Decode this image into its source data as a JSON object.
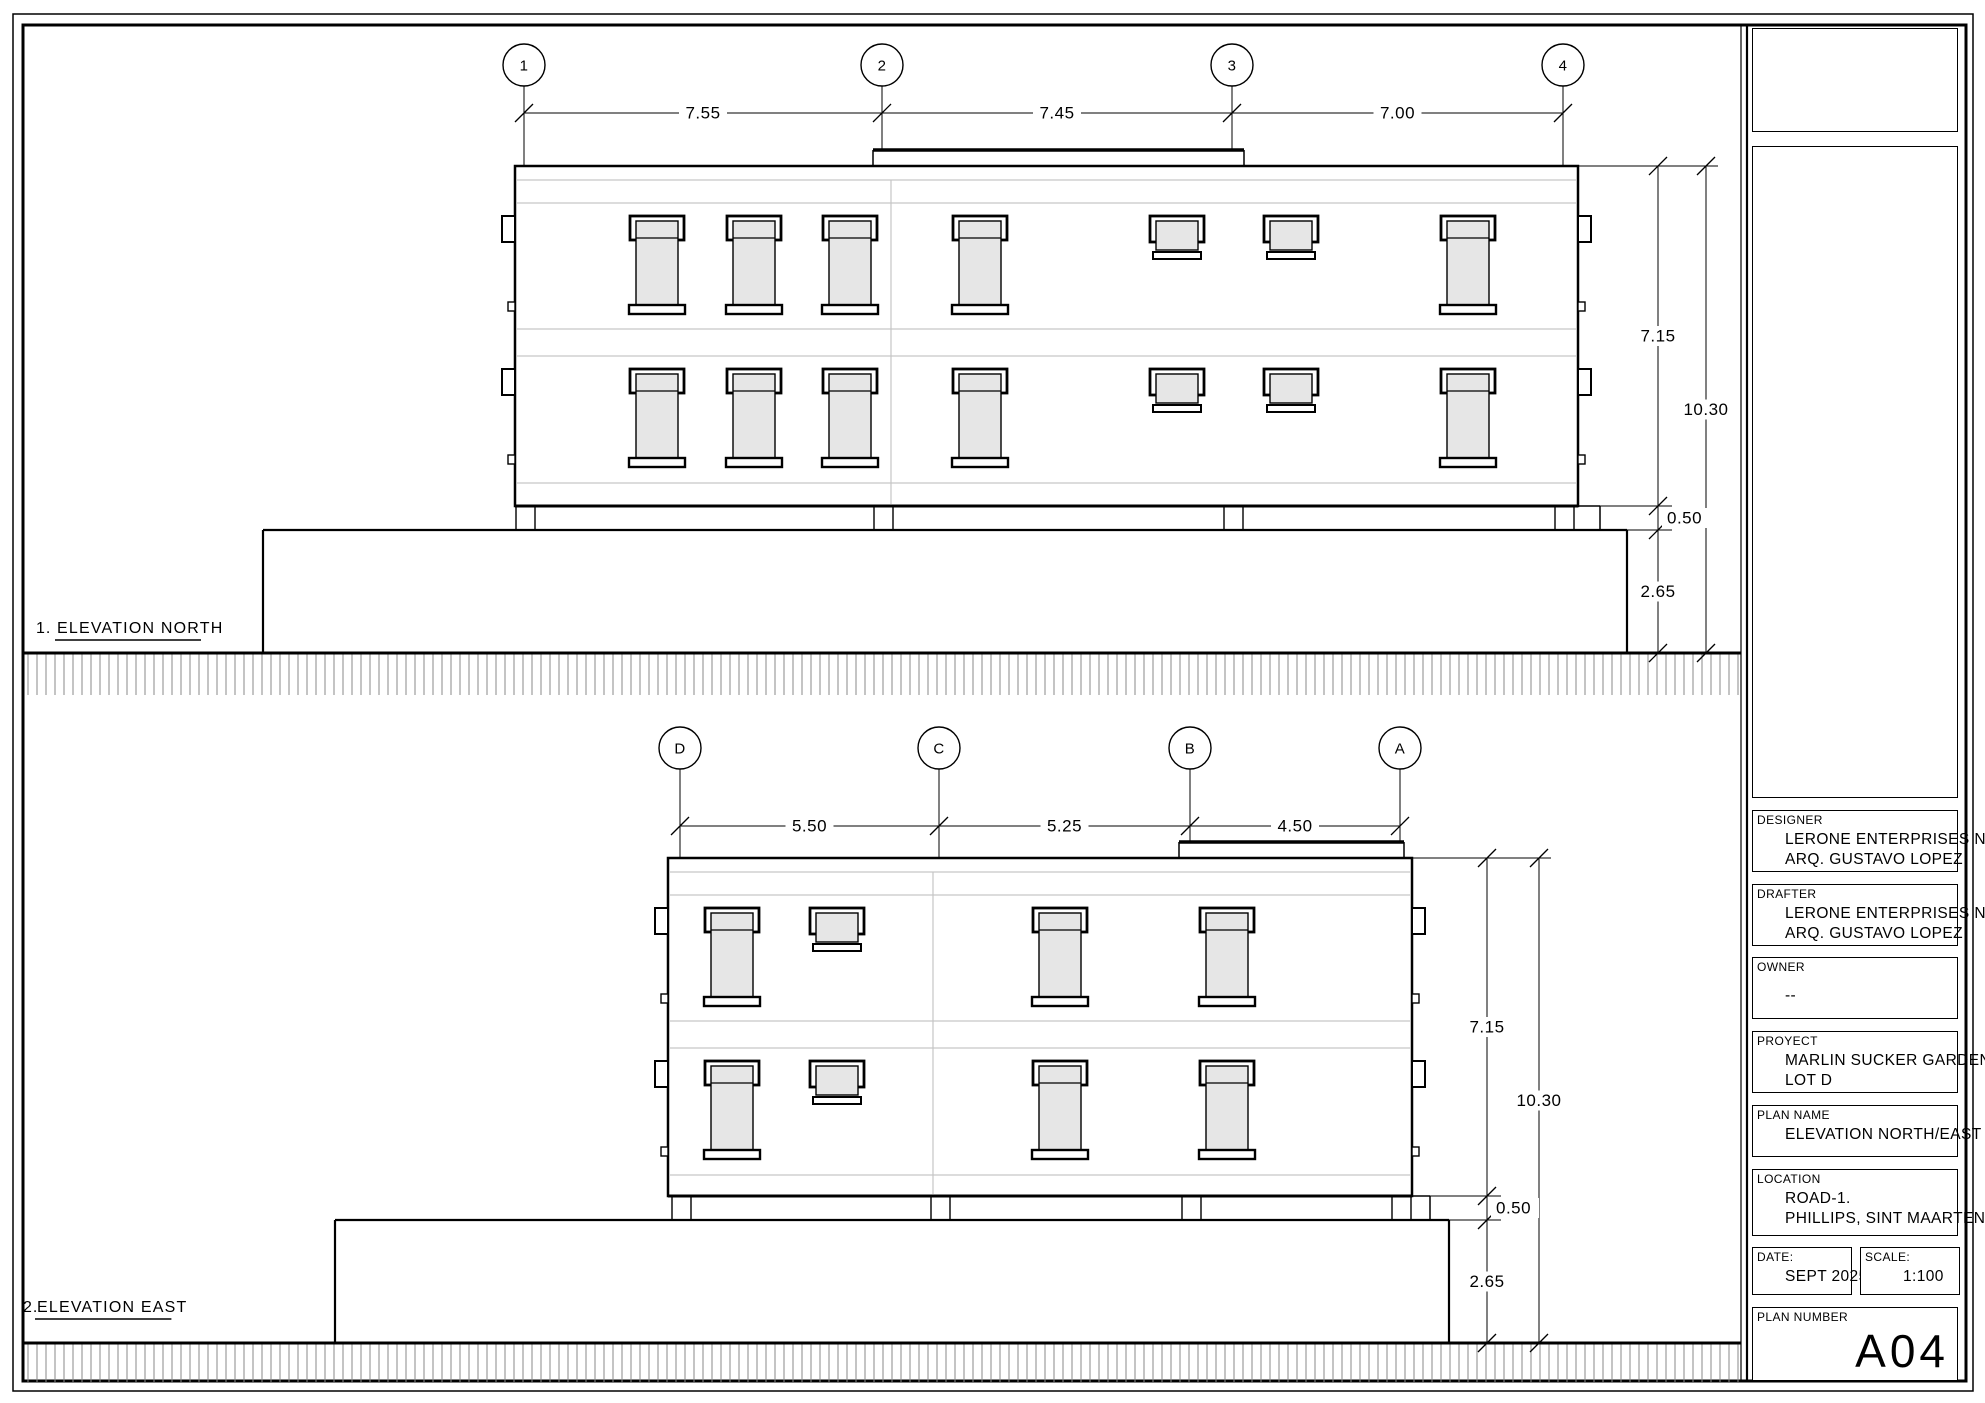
{
  "sheet": {
    "line_color": "#000000",
    "faint_color": "#c6c6c6",
    "glass_color": "#e6e6e6",
    "hatch_color": "#8a8a8a"
  },
  "drawings": [
    {
      "id": "north-elevation",
      "number": "1.",
      "title": "ELEVATION NORTH",
      "title_pos": {
        "num_x": 36,
        "title_x": 57,
        "y": 633
      },
      "bubbles_y": 65,
      "dim_line_y": 113,
      "grids": [
        {
          "label": "1",
          "x": 524
        },
        {
          "label": "2",
          "x": 882
        },
        {
          "label": "3",
          "x": 1232
        },
        {
          "label": "4",
          "x": 1563
        }
      ],
      "span_dims": [
        "7.55",
        "7.45",
        "7.00"
      ],
      "building": {
        "left": 515,
        "right": 1578,
        "top": 166,
        "bottom": 506
      },
      "parapet": {
        "left": 873,
        "right": 1244,
        "top": 150
      },
      "band_lines": [
        180,
        203,
        329,
        356,
        483
      ],
      "v_split_x": 891,
      "floors": [
        {
          "win_y": 216,
          "windows": [
            {
              "cx": 657,
              "type": "tall"
            },
            {
              "cx": 754,
              "type": "tall"
            },
            {
              "cx": 850,
              "type": "tall"
            },
            {
              "cx": 980,
              "type": "tall"
            },
            {
              "cx": 1177,
              "type": "small"
            },
            {
              "cx": 1291,
              "type": "small"
            },
            {
              "cx": 1468,
              "type": "tall"
            }
          ]
        },
        {
          "win_y": 369,
          "windows": [
            {
              "cx": 657,
              "type": "tall"
            },
            {
              "cx": 754,
              "type": "tall"
            },
            {
              "cx": 850,
              "type": "tall"
            },
            {
              "cx": 980,
              "type": "tall"
            },
            {
              "cx": 1177,
              "type": "small"
            },
            {
              "cx": 1291,
              "type": "small"
            },
            {
              "cx": 1468,
              "type": "tall"
            }
          ]
        }
      ],
      "base": {
        "plinth_top": 530,
        "plinth_left": 263,
        "plinth_right": 1627,
        "step_right": 1600,
        "ground": 653,
        "hatch_bottom": 695
      },
      "vdims": {
        "line1_x": 1658,
        "line2_x": 1706,
        "height_upper": "7.15",
        "height_total": "10.30",
        "plinth_band": "0.50",
        "plinth_height": "2.65"
      }
    },
    {
      "id": "east-elevation",
      "number": "2.",
      "title": "ELEVATION EAST",
      "title_pos": {
        "num_x": 23,
        "title_x": 37,
        "y": 1312
      },
      "bubbles_y": 748,
      "dim_line_y": 826,
      "grids": [
        {
          "label": "D",
          "x": 680
        },
        {
          "label": "C",
          "x": 939
        },
        {
          "label": "B",
          "x": 1190
        },
        {
          "label": "A",
          "x": 1400
        }
      ],
      "span_dims": [
        "5.50",
        "5.25",
        "4.50"
      ],
      "building": {
        "left": 668,
        "right": 1412,
        "top": 858,
        "bottom": 1196
      },
      "parapet": {
        "left": 1179,
        "right": 1404,
        "top": 842
      },
      "band_lines": [
        872,
        895,
        1021,
        1048,
        1175
      ],
      "v_split_x": 933,
      "floors": [
        {
          "win_y": 908,
          "windows": [
            {
              "cx": 732,
              "type": "tall"
            },
            {
              "cx": 837,
              "type": "small"
            },
            {
              "cx": 1060,
              "type": "tall"
            },
            {
              "cx": 1227,
              "type": "tall"
            }
          ]
        },
        {
          "win_y": 1061,
          "windows": [
            {
              "cx": 732,
              "type": "tall"
            },
            {
              "cx": 837,
              "type": "small"
            },
            {
              "cx": 1060,
              "type": "tall"
            },
            {
              "cx": 1227,
              "type": "tall"
            }
          ]
        }
      ],
      "base": {
        "plinth_top": 1220,
        "plinth_left": 335,
        "plinth_right": 1449,
        "step_right": 1430,
        "ground": 1343,
        "hatch_bottom": 1382
      },
      "vdims": {
        "line1_x": 1487,
        "line2_x": 1539,
        "height_upper": "7.15",
        "height_total": "10.30",
        "plinth_band": "0.50",
        "plinth_height": "2.65"
      }
    }
  ],
  "title_block": {
    "designer": {
      "label": "DESIGNER",
      "lines": [
        "LERONE ENTERPRISES N.V.",
        "ARQ. GUSTAVO LOPEZ"
      ]
    },
    "drafter": {
      "label": "DRAFTER",
      "lines": [
        "LERONE ENTERPRISES N.V.",
        "ARQ. GUSTAVO LOPEZ"
      ]
    },
    "owner": {
      "label": "OWNER",
      "lines": [
        "--"
      ]
    },
    "project": {
      "label": "PROYECT",
      "lines": [
        "MARLIN SUCKER GARDEN",
        "LOT D"
      ]
    },
    "plan_name": {
      "label": "PLAN NAME",
      "lines": [
        "ELEVATION NORTH/EAST"
      ]
    },
    "location": {
      "label": "LOCATION",
      "lines": [
        "ROAD-1.",
        "PHILLIPS, SINT MAARTEN"
      ]
    },
    "date": {
      "label": "DATE:",
      "value": "SEPT 2025"
    },
    "scale": {
      "label": "SCALE:",
      "value": "1:100"
    },
    "plan_number": {
      "label": "PLAN NUMBER",
      "value": "A04"
    }
  }
}
